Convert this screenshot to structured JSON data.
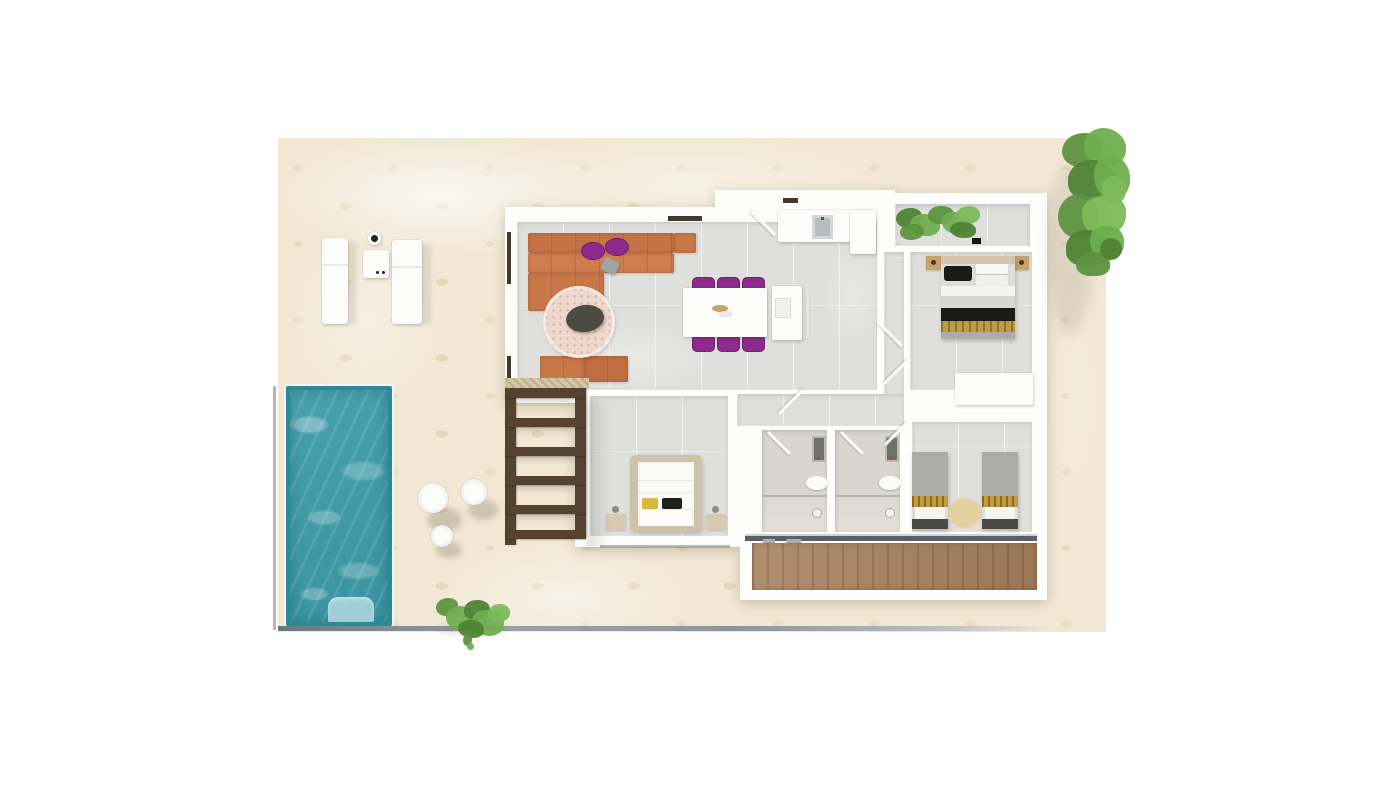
{
  "scene": {
    "type": "3d-floorplan-top-view-render",
    "areas": [
      "outdoor-tiled-terrace",
      "swimming-pool",
      "pergola",
      "sun-lounger-area",
      "living-room",
      "dining-area",
      "kitchen",
      "hallway",
      "master-bedroom-top-right",
      "bedroom-bottom-left",
      "twin-bedroom",
      "bathroom-1",
      "bathroom-2",
      "indoor-planter",
      "wood-deck",
      "garden-plants",
      "tree-top-right"
    ],
    "furniture": [
      "l-shaped-orange-sofa",
      "purple-floor-cushions",
      "round-pink-rug",
      "dark-coffee-table",
      "orange-bench",
      "dining-table",
      "six-purple-chairs",
      "kitchen-island",
      "kitchen-counter-with-sink",
      "tall-cabinet",
      "double-bed-black-gold",
      "double-bed-white-yellow",
      "two-single-beds",
      "wardrobes",
      "nightstands",
      "two-sun-loungers",
      "side-table",
      "three-round-pool-tables",
      "toilets",
      "vanity-mirrors",
      "showers"
    ]
  },
  "palette": {
    "background": "#ffffff",
    "terrace": "#f1e7d3",
    "wall": "#fdfdfc",
    "floor": "#dfdfdd",
    "bath_floor": "#d8d6ce",
    "pool_water": "#47a1ad",
    "pool_deep": "#3a93a0",
    "pool_border": "#2a8a96",
    "pool_steps": "#aed6dc",
    "sofa": "#c87748",
    "sofa_light": "#d0814f",
    "purple": "#8e2a8c",
    "purple_dark": "#6e1f6d",
    "rug": "#eed8cd",
    "rug_table": "#4b4b42",
    "pergola_wood": "#55422f",
    "deck_wood": "#a8815e",
    "plant_dark": "#4e8334",
    "plant_mid": "#6fae4f",
    "plant_light": "#7db95a",
    "plant_deep": "#5d9440",
    "bed_gold": "#c19b3f",
    "bed_black": "#1a1a18",
    "bed_gray": "#ababa9",
    "headboard": "#d3c5a9",
    "wood_light": "#c8a368",
    "fixture_gray": "#6f726a",
    "rail": "#566066",
    "fence": "#8a9197",
    "sill": "#d5c6a5",
    "frame_dark": "#44382c",
    "white_obj": "#fcfcfb",
    "twin_rug": "#e5d0a2"
  }
}
